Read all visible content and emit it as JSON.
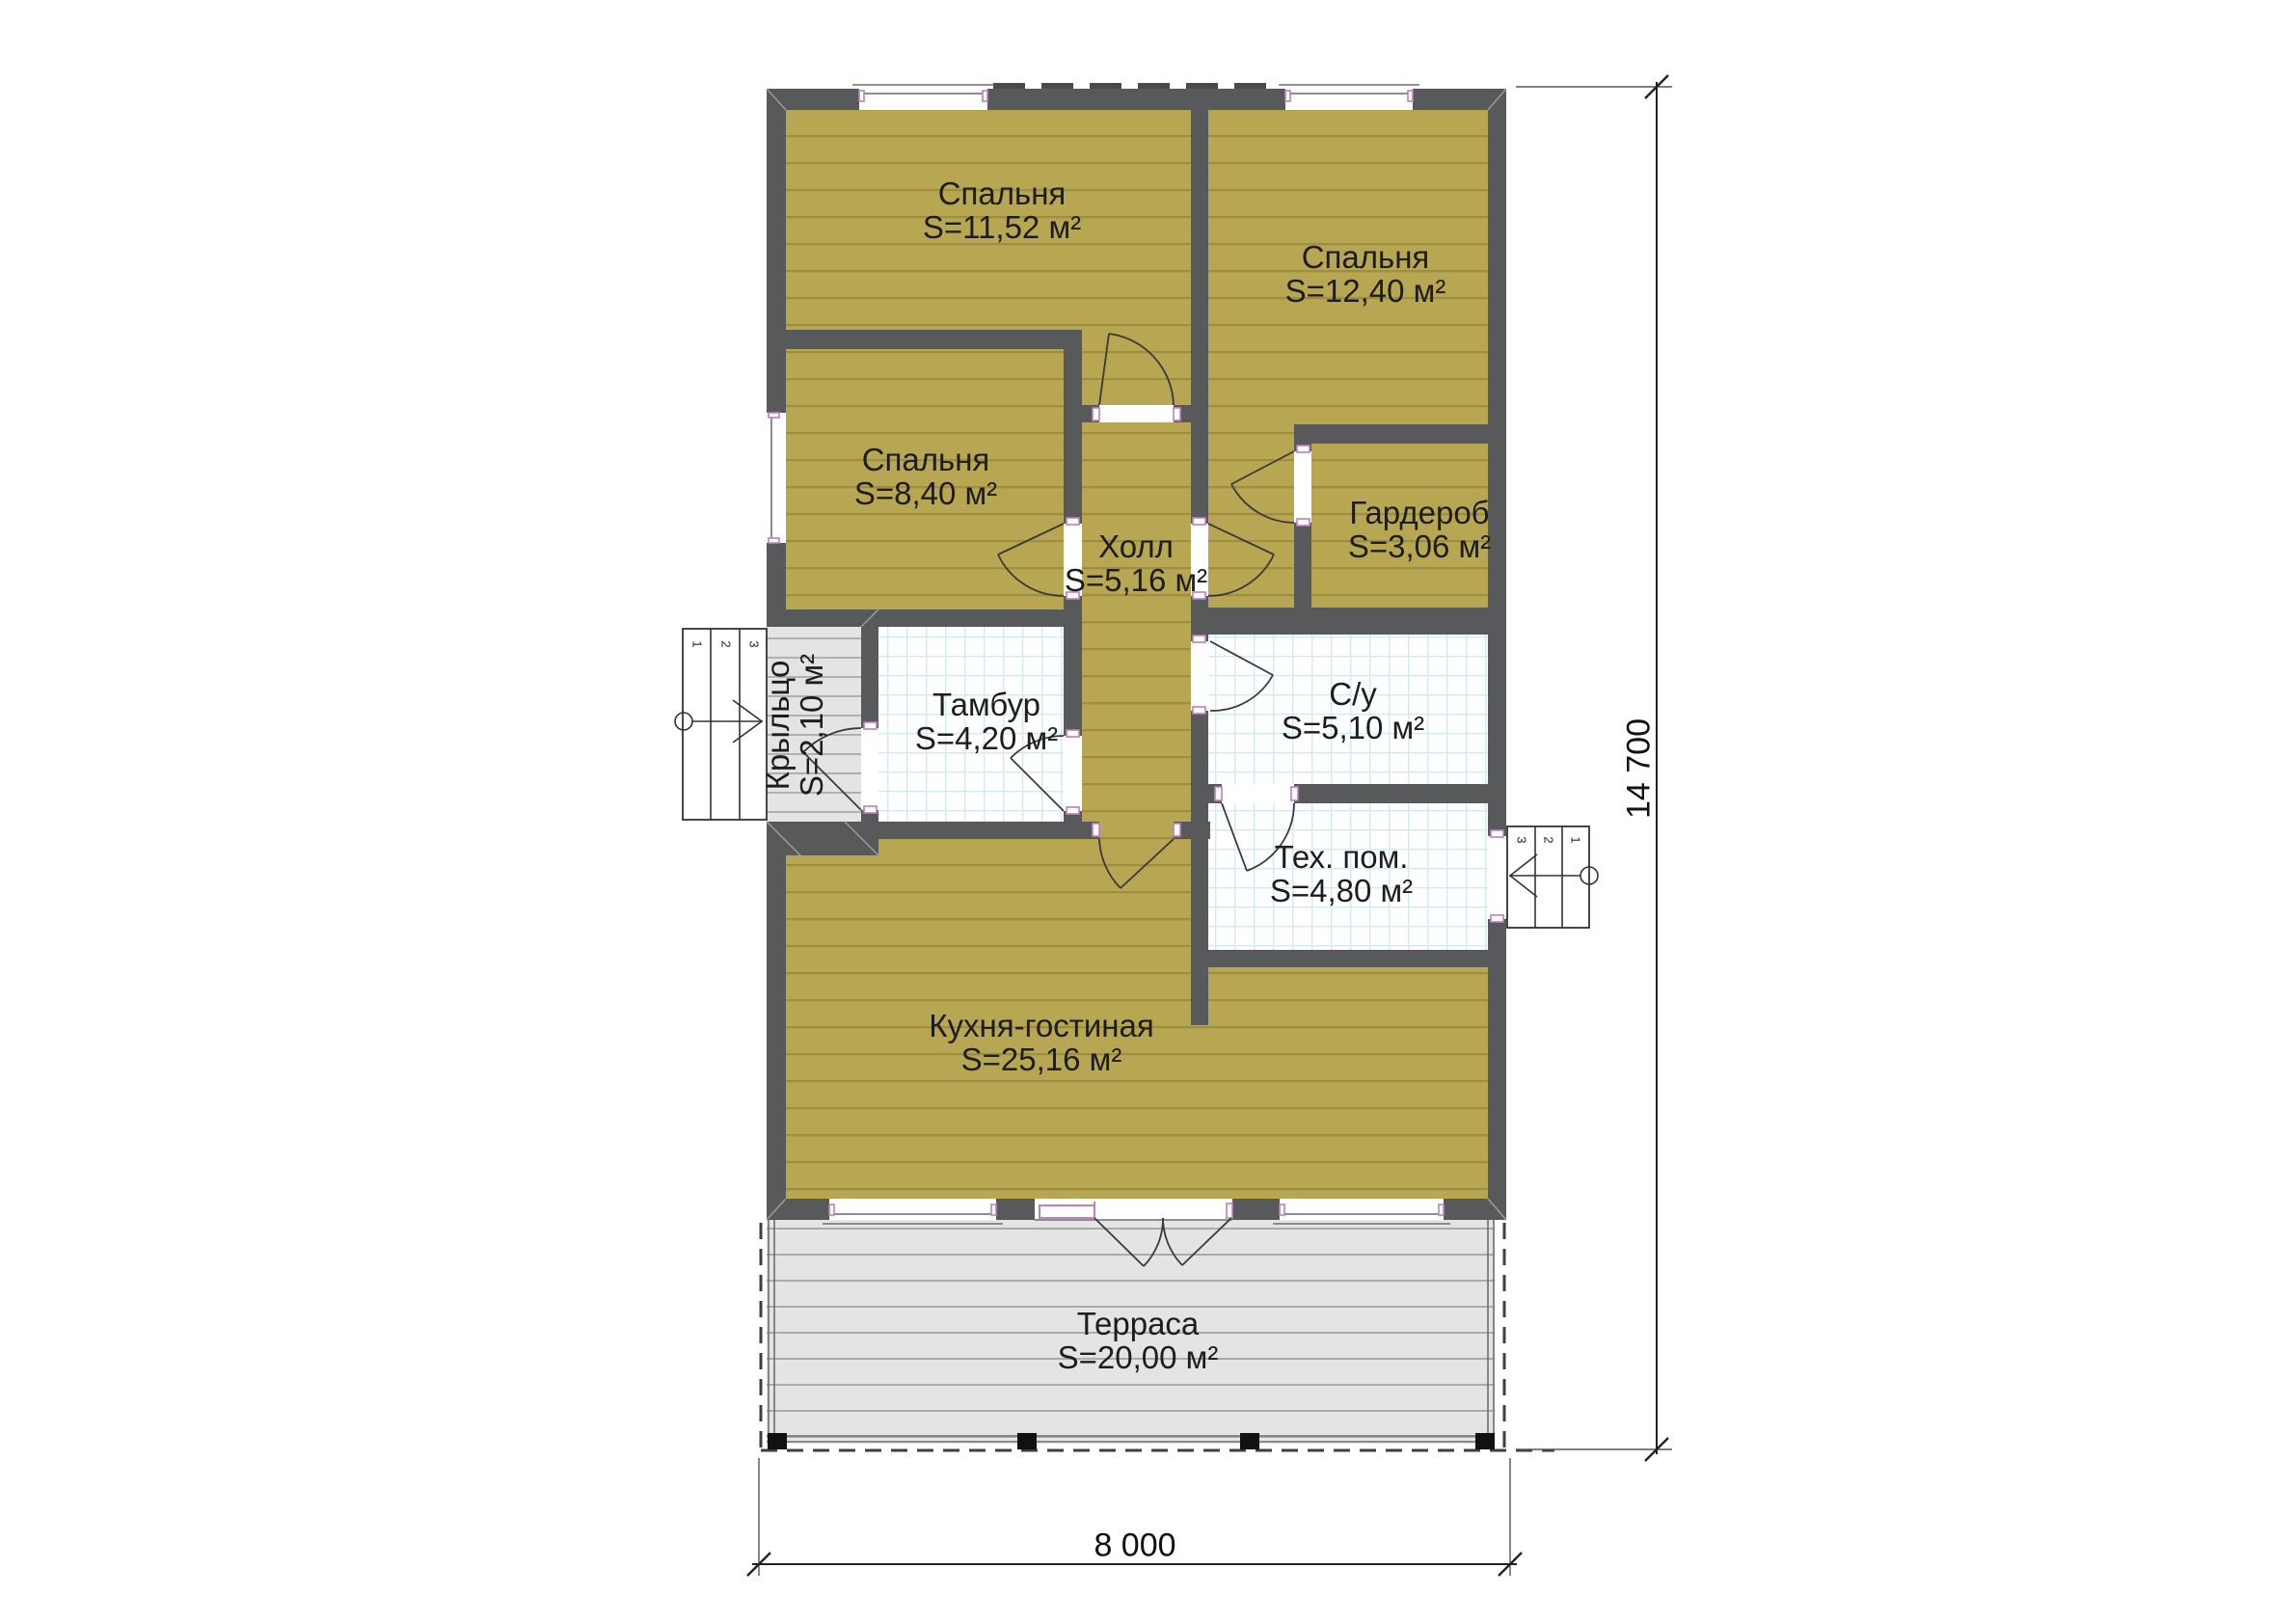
{
  "plan": {
    "rooms": [
      {
        "name": "Спальня",
        "area": "S=11,52 м²"
      },
      {
        "name": "Спальня",
        "area": "S=12,40 м²"
      },
      {
        "name": "Спальня",
        "area": "S=8,40 м²"
      },
      {
        "name": "Гардероб",
        "area": "S=3,06 м²"
      },
      {
        "name": "Холл",
        "area": "S=5,16 м²"
      },
      {
        "name": "Тамбур",
        "area": "S=4,20 м²"
      },
      {
        "name": "С/у",
        "area": "S=5,10 м²"
      },
      {
        "name": "Тех. пом.",
        "area": "S=4,80 м²"
      },
      {
        "name": "Кухня-гостиная",
        "area": "S=25,16 м²"
      },
      {
        "name": "Терраса",
        "area": "S=20,00 м²"
      },
      {
        "name": "Крыльцо",
        "area": "S=2,10 м²"
      }
    ],
    "dimensions": {
      "width": "8 000",
      "height": "14 700"
    },
    "stairs": {
      "left": [
        "1",
        "2",
        "3"
      ],
      "right": [
        "3",
        "2",
        "1"
      ]
    },
    "colors": {
      "wall": "#58595b",
      "room_fill": "#b7a652",
      "room_line": "#9f8e42",
      "deck_fill": "#e4e4e4",
      "deck_line": "#ababab",
      "porch_line": "#b0b0b0",
      "tile_line": "#d6e9f2",
      "door_accent": "#c07fc0",
      "ink": "#1d1d1d"
    }
  }
}
